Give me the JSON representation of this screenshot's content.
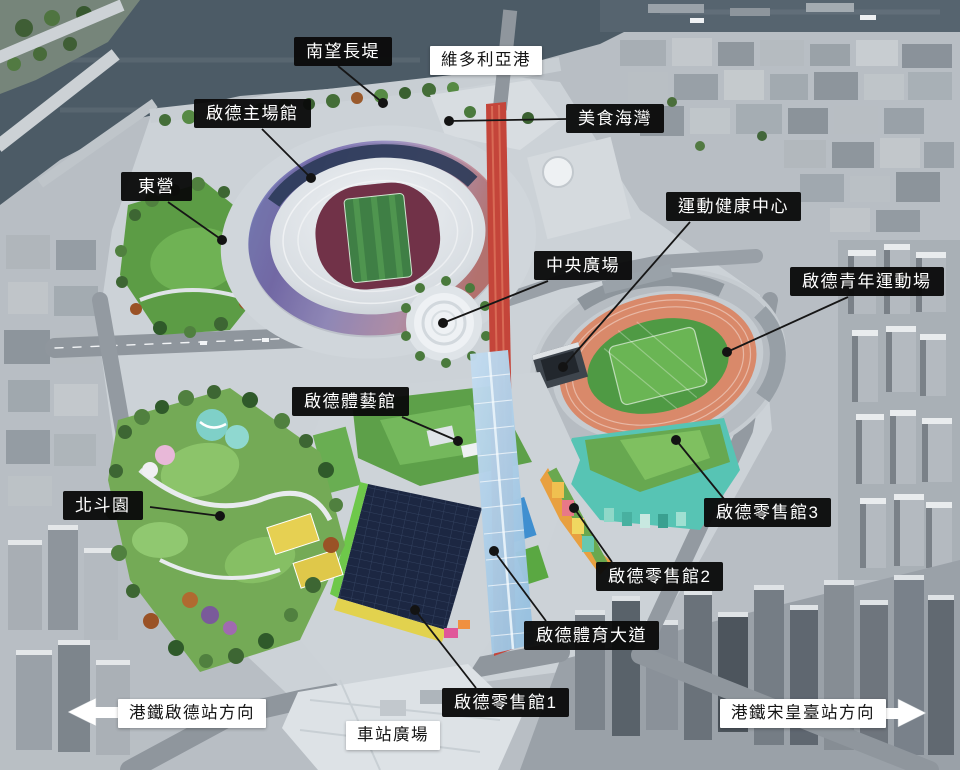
{
  "labels": {
    "south_breakwater": {
      "text": "南望長堤",
      "variant": "dark"
    },
    "victoria_harbour": {
      "text": "維多利亞港",
      "variant": "light"
    },
    "main_stadium": {
      "text": "啟德主場館",
      "variant": "dark"
    },
    "dining_cove": {
      "text": "美食海灣",
      "variant": "dark"
    },
    "east_camp": {
      "text": "東營",
      "variant": "dark"
    },
    "wellness_centre": {
      "text": "運動健康中心",
      "variant": "dark"
    },
    "central_square": {
      "text": "中央廣場",
      "variant": "dark"
    },
    "youth_sports_ground": {
      "text": "啟德青年運動場",
      "variant": "dark"
    },
    "arena": {
      "text": "啟德體藝館",
      "variant": "dark"
    },
    "dipper_garden": {
      "text": "北斗園",
      "variant": "dark"
    },
    "retail_3": {
      "text": "啟德零售館3",
      "variant": "dark"
    },
    "retail_2": {
      "text": "啟德零售館2",
      "variant": "dark"
    },
    "sports_avenue": {
      "text": "啟德體育大道",
      "variant": "dark"
    },
    "retail_1": {
      "text": "啟德零售館1",
      "variant": "dark"
    },
    "station_square": {
      "text": "車站廣場",
      "variant": "light"
    },
    "mtr_kai_tak": {
      "text": "港鐵啟德站方向",
      "variant": "light",
      "arrow": "left"
    },
    "mtr_sung_wong_toi": {
      "text": "港鐵宋皇臺站方向",
      "variant": "light",
      "arrow": "right"
    }
  },
  "colors": {
    "label_dark_bg": "#0a0a0a",
    "label_dark_text": "#ffffff",
    "label_light_bg": "#ffffff",
    "label_light_text": "#151515",
    "leader_line": "#161616",
    "water": "#4c5b66",
    "lawn_green": "#5c9c45",
    "running_track": "#d9896a",
    "avenue_red": "#c4453a",
    "canopy_blue": "#aed3ee",
    "stadium_shell_purple": "#8b84bf",
    "solar_roof_navy": "#1c2742",
    "retail_teal": "#57c4b4"
  }
}
